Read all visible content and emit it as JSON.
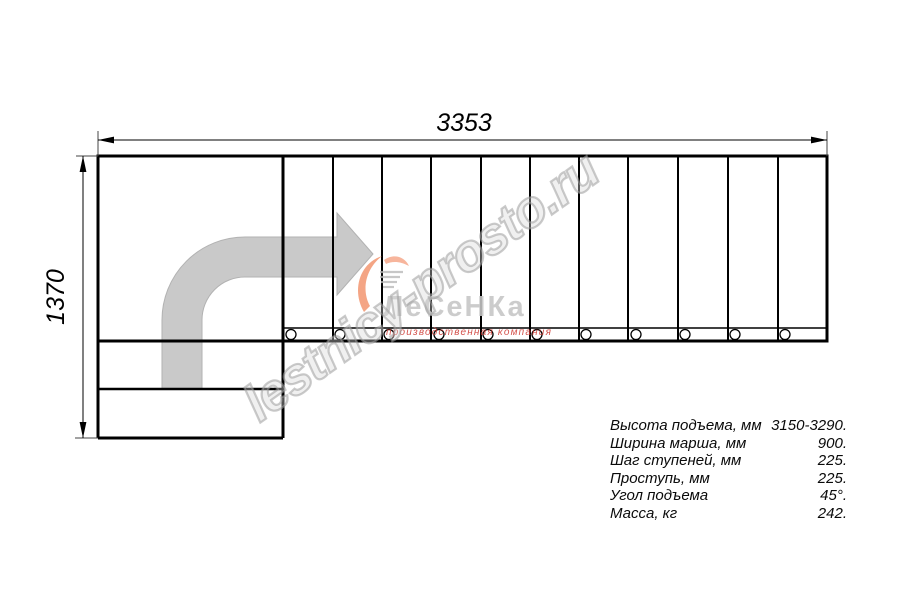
{
  "dimensions": {
    "width_label": "3353",
    "height_label": "1370"
  },
  "watermark": {
    "text": "lestnicy-prosto.ru"
  },
  "logo": {
    "name": "ЛеСеНКа",
    "subtitle": "производственная компания"
  },
  "specs": {
    "rows": [
      {
        "label": "Высота подъема, мм",
        "value": "3150-3290."
      },
      {
        "label": "Ширина марша, мм",
        "value": "900."
      },
      {
        "label": "Шаг ступеней, мм",
        "value": "225."
      },
      {
        "label": "Проступь, мм",
        "value": "225."
      },
      {
        "label": "Угол подъема",
        "value": "45°."
      },
      {
        "label": "Масса, кг",
        "value": "242."
      }
    ]
  },
  "colors": {
    "line": "#000000",
    "arrow_fill": "#c9c9c9",
    "logo_orange": "#f0875c",
    "logo_red": "#cf3a33",
    "watermark_gray": "#a8a8a8"
  }
}
